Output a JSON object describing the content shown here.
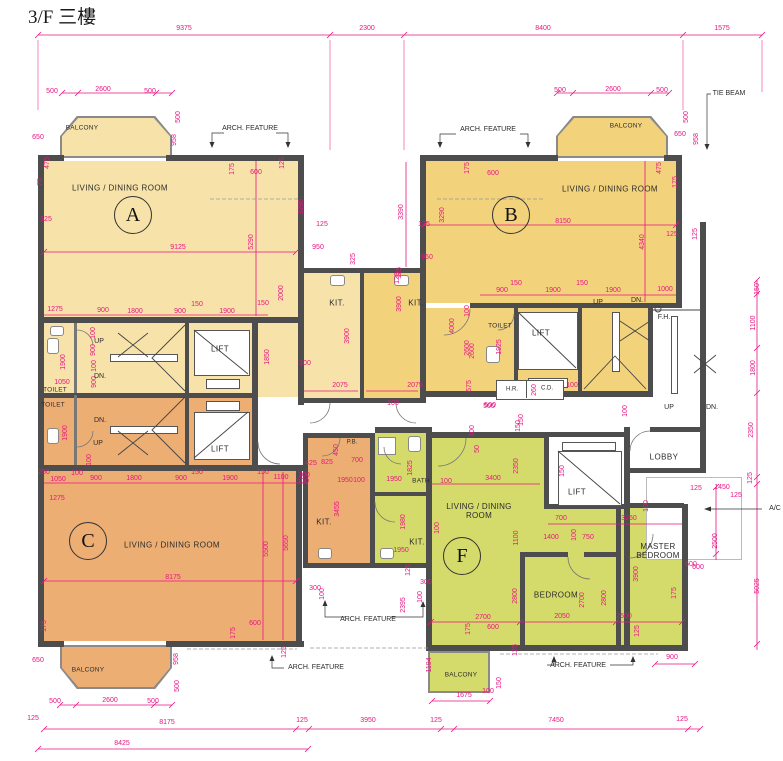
{
  "title": "3/F 三樓",
  "colors": {
    "unitA": "#F7E3A9",
    "unitB": "#F3D27C",
    "unitC": "#EDAE74",
    "unitF": "#D5DB6A",
    "wall": "#4D4D4D",
    "dim": "#E91583"
  },
  "units": [
    {
      "letter": "A",
      "main_room": "LIVING / DINING ROOM"
    },
    {
      "letter": "B",
      "main_room": "LIVING / DINING ROOM"
    },
    {
      "letter": "C",
      "main_room": "LIVING / DINING ROOM"
    },
    {
      "letter": "F",
      "main_room": "LIVING / DINING ROOM"
    }
  ],
  "labels": [
    {
      "t": "9375",
      "x": 184,
      "y": 29
    },
    {
      "t": "2300",
      "x": 367,
      "y": 29
    },
    {
      "t": "8400",
      "x": 543,
      "y": 29
    },
    {
      "t": "1575",
      "x": 722,
      "y": 29
    },
    {
      "n": "unit-a-balcony-label",
      "t": "BALCONY",
      "x": 82,
      "y": 128,
      "s": "rs"
    },
    {
      "t": "500",
      "x": 52,
      "y": 92
    },
    {
      "t": "2600",
      "x": 103,
      "y": 90
    },
    {
      "t": "500",
      "x": 150,
      "y": 92
    },
    {
      "t": "650",
      "x": 38,
      "y": 138
    },
    {
      "t": "500",
      "x": 179,
      "y": 117,
      "v": 1
    },
    {
      "t": "958",
      "x": 175,
      "y": 140,
      "v": 1
    },
    {
      "n": "arch-feature-top-left",
      "t": "ARCH. FEATURE",
      "x": 250,
      "y": 129,
      "s": "a"
    },
    {
      "n": "arch-feature-top-right",
      "t": "ARCH. FEATURE",
      "x": 488,
      "y": 130,
      "s": "a"
    },
    {
      "n": "tie-beam-label",
      "t": "TIE BEAM",
      "x": 729,
      "y": 94,
      "s": "a"
    },
    {
      "n": "unit-a-room-label",
      "t": "LIVING / DINING ROOM",
      "x": 120,
      "y": 188,
      "s": "r"
    },
    {
      "n": "unit-a-letter",
      "t": "A",
      "x": 133,
      "y": 215,
      "s": "c"
    },
    {
      "t": "475",
      "x": 48,
      "y": 163,
      "v": 1
    },
    {
      "t": "75",
      "x": 41,
      "y": 182,
      "v": 1
    },
    {
      "t": "125",
      "x": 46,
      "y": 220
    },
    {
      "t": "9125",
      "x": 178,
      "y": 248
    },
    {
      "t": "5290",
      "x": 252,
      "y": 242,
      "v": 1
    },
    {
      "t": "3290",
      "x": 302,
      "y": 207,
      "v": 1
    },
    {
      "t": "175",
      "x": 233,
      "y": 169,
      "v": 1
    },
    {
      "t": "600",
      "x": 256,
      "y": 173
    },
    {
      "t": "125",
      "x": 283,
      "y": 163,
      "v": 1
    },
    {
      "t": "3390",
      "x": 402,
      "y": 212,
      "v": 1
    },
    {
      "t": "125",
      "x": 322,
      "y": 225
    },
    {
      "t": "950",
      "x": 318,
      "y": 248
    },
    {
      "t": "325",
      "x": 354,
      "y": 259,
      "v": 1
    },
    {
      "t": "125",
      "x": 424,
      "y": 225
    },
    {
      "t": "950",
      "x": 427,
      "y": 258
    },
    {
      "t": "125",
      "x": 400,
      "y": 273,
      "v": 1
    },
    {
      "n": "unit-b-room-label",
      "t": "LIVING / DINING ROOM",
      "x": 610,
      "y": 189,
      "s": "r"
    },
    {
      "n": "unit-b-letter",
      "t": "B",
      "x": 511,
      "y": 215,
      "s": "c"
    },
    {
      "t": "175",
      "x": 468,
      "y": 168,
      "v": 1
    },
    {
      "t": "600",
      "x": 493,
      "y": 174
    },
    {
      "t": "3290",
      "x": 443,
      "y": 215,
      "v": 1
    },
    {
      "t": "8150",
      "x": 563,
      "y": 222
    },
    {
      "t": "125",
      "x": 672,
      "y": 235
    },
    {
      "t": "4340",
      "x": 643,
      "y": 242,
      "v": 1
    },
    {
      "t": "475",
      "x": 660,
      "y": 168,
      "v": 1
    },
    {
      "t": "175",
      "x": 676,
      "y": 182,
      "v": 1
    },
    {
      "n": "unit-b-balcony-label",
      "t": "BALCONY",
      "x": 626,
      "y": 126,
      "s": "rs"
    },
    {
      "t": "500",
      "x": 560,
      "y": 91
    },
    {
      "t": "2600",
      "x": 613,
      "y": 90
    },
    {
      "t": "500",
      "x": 662,
      "y": 91
    },
    {
      "t": "650",
      "x": 680,
      "y": 135
    },
    {
      "t": "500",
      "x": 687,
      "y": 117,
      "v": 1
    },
    {
      "t": "958",
      "x": 697,
      "y": 139,
      "v": 1
    },
    {
      "t": "900",
      "x": 502,
      "y": 291
    },
    {
      "t": "150",
      "x": 516,
      "y": 284
    },
    {
      "t": "1900",
      "x": 553,
      "y": 291
    },
    {
      "t": "150",
      "x": 582,
      "y": 284
    },
    {
      "t": "1900",
      "x": 613,
      "y": 291
    },
    {
      "t": "1000",
      "x": 665,
      "y": 290
    },
    {
      "n": "b-stair-up",
      "t": "UP",
      "x": 598,
      "y": 303,
      "s": "a"
    },
    {
      "n": "b-stair-dn",
      "t": "DN.",
      "x": 637,
      "y": 301,
      "s": "a"
    },
    {
      "n": "fire-hydrant-label",
      "t": "F.H.",
      "x": 664,
      "y": 318,
      "s": "a"
    },
    {
      "n": "unit-b-toilet-label",
      "t": "TOILET",
      "x": 500,
      "y": 326,
      "s": "rs"
    },
    {
      "n": "lift-b-label",
      "t": "LIFT",
      "x": 541,
      "y": 333,
      "s": "r"
    },
    {
      "t": "1925",
      "x": 500,
      "y": 347,
      "v": 1
    },
    {
      "t": "2600",
      "x": 473,
      "y": 351,
      "v": 1
    },
    {
      "n": "hose-reel-label",
      "t": "H.R.",
      "x": 512,
      "y": 390,
      "s": "a6"
    },
    {
      "n": "cable-duct-label",
      "t": "C.D.",
      "x": 547,
      "y": 389,
      "s": "a6"
    },
    {
      "t": "100",
      "x": 572,
      "y": 386
    },
    {
      "t": "260",
      "x": 535,
      "y": 390,
      "v": 1
    },
    {
      "t": "500",
      "x": 489,
      "y": 407
    },
    {
      "t": "150",
      "x": 522,
      "y": 420,
      "v": 1
    },
    {
      "t": "100",
      "x": 626,
      "y": 411,
      "v": 1
    },
    {
      "n": "ext-stair-up",
      "t": "UP",
      "x": 669,
      "y": 408,
      "s": "a"
    },
    {
      "n": "ext-stair-dn",
      "t": "DN.",
      "x": 712,
      "y": 408,
      "s": "a"
    },
    {
      "t": "125",
      "x": 696,
      "y": 234,
      "v": 1
    },
    {
      "t": "150",
      "x": 758,
      "y": 289,
      "v": 1
    },
    {
      "t": "1100",
      "x": 754,
      "y": 323,
      "v": 1
    },
    {
      "t": "1800",
      "x": 754,
      "y": 368,
      "v": 1
    },
    {
      "t": "2350",
      "x": 752,
      "y": 430,
      "v": 1
    },
    {
      "t": "125",
      "x": 751,
      "y": 478,
      "v": 1
    },
    {
      "t": "5025",
      "x": 758,
      "y": 586,
      "v": 1
    },
    {
      "t": "2500",
      "x": 716,
      "y": 541,
      "v": 1
    },
    {
      "t": "125",
      "x": 696,
      "y": 489
    },
    {
      "t": "1450",
      "x": 722,
      "y": 488
    },
    {
      "t": "125",
      "x": 736,
      "y": 496
    },
    {
      "n": "ac-label",
      "t": "A/C",
      "x": 775,
      "y": 509,
      "s": "a"
    },
    {
      "t": "100",
      "x": 647,
      "y": 506,
      "v": 1
    },
    {
      "t": "600",
      "x": 698,
      "y": 568
    },
    {
      "n": "lobby-label",
      "t": "LOBBY",
      "x": 664,
      "y": 457,
      "s": "r"
    },
    {
      "n": "master-bedroom-label",
      "t": "MASTER\nBEDROOM",
      "x": 658,
      "y": 551,
      "s": "r2"
    },
    {
      "t": "1275",
      "x": 55,
      "y": 310
    },
    {
      "t": "900",
      "x": 103,
      "y": 311
    },
    {
      "t": "1800",
      "x": 135,
      "y": 312
    },
    {
      "t": "900",
      "x": 180,
      "y": 312
    },
    {
      "t": "150",
      "x": 197,
      "y": 305
    },
    {
      "t": "1900",
      "x": 227,
      "y": 312
    },
    {
      "t": "150",
      "x": 263,
      "y": 304
    },
    {
      "t": "100",
      "x": 94,
      "y": 333,
      "v": 1
    },
    {
      "t": "900",
      "x": 94,
      "y": 350,
      "v": 1
    },
    {
      "t": "100",
      "x": 95,
      "y": 366,
      "v": 1
    },
    {
      "t": "900",
      "x": 95,
      "y": 382,
      "v": 1
    },
    {
      "t": "1050",
      "x": 62,
      "y": 383
    },
    {
      "t": "1900",
      "x": 64,
      "y": 362,
      "v": 1
    },
    {
      "t": "1900",
      "x": 66,
      "y": 433,
      "v": 1
    },
    {
      "t": "100",
      "x": 90,
      "y": 460,
      "v": 1
    },
    {
      "n": "unit-a-toilet-label",
      "t": "TOILET",
      "x": 55,
      "y": 390,
      "s": "rs"
    },
    {
      "n": "unit-c-toilet-label",
      "t": "TOILET",
      "x": 53,
      "y": 405,
      "s": "rs"
    },
    {
      "n": "a-stair-up",
      "t": "UP",
      "x": 99,
      "y": 342,
      "s": "a"
    },
    {
      "n": "a-stair-dn",
      "t": "DN.",
      "x": 100,
      "y": 377,
      "s": "a"
    },
    {
      "n": "c-stair-dn",
      "t": "DN.",
      "x": 100,
      "y": 421,
      "s": "a"
    },
    {
      "n": "c-stair-up",
      "t": "UP",
      "x": 98,
      "y": 444,
      "s": "a"
    },
    {
      "n": "lift-a-label",
      "t": "LIFT",
      "x": 220,
      "y": 349,
      "s": "r"
    },
    {
      "n": "lift-c-label",
      "t": "LIFT",
      "x": 220,
      "y": 449,
      "s": "r"
    },
    {
      "t": "1850",
      "x": 268,
      "y": 357,
      "v": 1
    },
    {
      "n": "unit-a-kitchen-label",
      "t": "KIT.",
      "x": 337,
      "y": 303,
      "s": "r"
    },
    {
      "n": "unit-b-kitchen-label",
      "t": "KIT.",
      "x": 416,
      "y": 303,
      "s": "r"
    },
    {
      "t": "2000",
      "x": 282,
      "y": 293,
      "v": 1
    },
    {
      "t": "3900",
      "x": 348,
      "y": 336,
      "v": 1
    },
    {
      "t": "3900",
      "x": 400,
      "y": 304,
      "v": 1
    },
    {
      "t": "4000",
      "x": 453,
      "y": 326,
      "v": 1
    },
    {
      "t": "125",
      "x": 398,
      "y": 278,
      "v": 1
    },
    {
      "t": "2075",
      "x": 340,
      "y": 386
    },
    {
      "t": "2075",
      "x": 415,
      "y": 386
    },
    {
      "t": "100",
      "x": 305,
      "y": 364
    },
    {
      "t": "100",
      "x": 393,
      "y": 404
    },
    {
      "t": "100",
      "x": 468,
      "y": 311,
      "v": 1
    },
    {
      "t": "2600",
      "x": 468,
      "y": 348,
      "v": 1
    },
    {
      "t": "575",
      "x": 470,
      "y": 386,
      "v": 1
    },
    {
      "t": "500",
      "x": 490,
      "y": 406
    },
    {
      "t": "250",
      "x": 44,
      "y": 473
    },
    {
      "t": "1050",
      "x": 58,
      "y": 480
    },
    {
      "t": "100",
      "x": 77,
      "y": 474
    },
    {
      "t": "900",
      "x": 96,
      "y": 479
    },
    {
      "t": "1800",
      "x": 134,
      "y": 479
    },
    {
      "t": "900",
      "x": 181,
      "y": 479
    },
    {
      "t": "150",
      "x": 197,
      "y": 473
    },
    {
      "t": "1900",
      "x": 230,
      "y": 479
    },
    {
      "t": "150",
      "x": 263,
      "y": 473
    },
    {
      "t": "1100",
      "x": 281,
      "y": 478
    },
    {
      "t": "100",
      "x": 304,
      "y": 476
    },
    {
      "t": "1275",
      "x": 57,
      "y": 499
    },
    {
      "n": "unit-c-letter",
      "t": "C",
      "x": 88,
      "y": 541,
      "s": "c"
    },
    {
      "n": "unit-c-room-label",
      "t": "LIVING / DINING ROOM",
      "x": 172,
      "y": 545,
      "s": "r"
    },
    {
      "t": "8175",
      "x": 173,
      "y": 578
    },
    {
      "t": "5500",
      "x": 267,
      "y": 549,
      "v": 1
    },
    {
      "t": "5650",
      "x": 287,
      "y": 543,
      "v": 1
    },
    {
      "t": "175",
      "x": 45,
      "y": 626,
      "v": 1
    },
    {
      "t": "600",
      "x": 255,
      "y": 624
    },
    {
      "t": "175",
      "x": 234,
      "y": 633,
      "v": 1
    },
    {
      "t": "125",
      "x": 285,
      "y": 652,
      "v": 1
    },
    {
      "t": "650",
      "x": 38,
      "y": 661
    },
    {
      "n": "unit-c-balcony-label",
      "t": "BALCONY",
      "x": 88,
      "y": 670,
      "s": "rs"
    },
    {
      "t": "958",
      "x": 177,
      "y": 659,
      "v": 1
    },
    {
      "t": "500",
      "x": 178,
      "y": 686,
      "v": 1
    },
    {
      "t": "500",
      "x": 55,
      "y": 702
    },
    {
      "t": "2600",
      "x": 110,
      "y": 701
    },
    {
      "t": "500",
      "x": 153,
      "y": 702
    },
    {
      "t": "125",
      "x": 33,
      "y": 719
    },
    {
      "t": "8175",
      "x": 167,
      "y": 723
    },
    {
      "t": "8425",
      "x": 122,
      "y": 744
    },
    {
      "n": "arch-feature-bottom-left",
      "t": "ARCH. FEATURE",
      "x": 316,
      "y": 668,
      "s": "a"
    },
    {
      "n": "pipe-duct-label",
      "t": "P.B.",
      "x": 352,
      "y": 443,
      "s": "a6"
    },
    {
      "t": "450",
      "x": 337,
      "y": 450,
      "v": 1
    },
    {
      "t": "425",
      "x": 311,
      "y": 464
    },
    {
      "t": "825",
      "x": 327,
      "y": 463
    },
    {
      "t": "700",
      "x": 357,
      "y": 461
    },
    {
      "t": "100",
      "x": 303,
      "y": 482
    },
    {
      "t": "1950",
      "x": 345,
      "y": 481
    },
    {
      "t": "100",
      "x": 359,
      "y": 481
    },
    {
      "t": "1950",
      "x": 394,
      "y": 480
    },
    {
      "n": "bath-label",
      "t": "BATH",
      "x": 421,
      "y": 481,
      "s": "rs"
    },
    {
      "t": "100",
      "x": 446,
      "y": 482
    },
    {
      "t": "1825",
      "x": 411,
      "y": 468,
      "v": 1
    },
    {
      "t": "3455",
      "x": 338,
      "y": 509,
      "v": 1
    },
    {
      "n": "unit-c-kitchen-label",
      "t": "KIT.",
      "x": 324,
      "y": 522,
      "s": "r"
    },
    {
      "t": "1980",
      "x": 404,
      "y": 522,
      "v": 1
    },
    {
      "n": "unit-f-kitchen-label",
      "t": "KIT.",
      "x": 417,
      "y": 542,
      "s": "r"
    },
    {
      "t": "1950",
      "x": 401,
      "y": 551
    },
    {
      "t": "125",
      "x": 409,
      "y": 570,
      "v": 1
    },
    {
      "t": "300",
      "x": 315,
      "y": 589
    },
    {
      "t": "100",
      "x": 323,
      "y": 594,
      "v": 1
    },
    {
      "t": "300",
      "x": 426,
      "y": 583
    },
    {
      "t": "100",
      "x": 421,
      "y": 597,
      "v": 1
    },
    {
      "t": "2395",
      "x": 404,
      "y": 605,
      "v": 1
    },
    {
      "n": "arch-feature-bottom-mid",
      "t": "ARCH. FEATURE",
      "x": 368,
      "y": 620,
      "s": "a"
    },
    {
      "t": "100",
      "x": 473,
      "y": 431,
      "v": 1
    },
    {
      "t": "150",
      "x": 519,
      "y": 426,
      "v": 1
    },
    {
      "t": "50",
      "x": 478,
      "y": 449,
      "v": 1
    },
    {
      "t": "3400",
      "x": 493,
      "y": 479
    },
    {
      "t": "2350",
      "x": 517,
      "y": 466,
      "v": 1
    },
    {
      "t": "150",
      "x": 563,
      "y": 471,
      "v": 1
    },
    {
      "n": "lift-f-label",
      "t": "LIFT",
      "x": 577,
      "y": 492,
      "s": "r"
    },
    {
      "n": "unit-f-room-label",
      "t": "LIVING / DINING\nROOM",
      "x": 479,
      "y": 511,
      "s": "r2"
    },
    {
      "n": "unit-f-letter",
      "t": "F",
      "x": 462,
      "y": 556,
      "s": "c"
    },
    {
      "t": "100",
      "x": 438,
      "y": 528,
      "v": 1
    },
    {
      "t": "1100",
      "x": 517,
      "y": 538,
      "v": 1
    },
    {
      "t": "700",
      "x": 561,
      "y": 519
    },
    {
      "t": "3250",
      "x": 629,
      "y": 519
    },
    {
      "t": "1400",
      "x": 551,
      "y": 538
    },
    {
      "t": "100",
      "x": 575,
      "y": 535,
      "v": 1
    },
    {
      "t": "750",
      "x": 588,
      "y": 538
    },
    {
      "t": "3900",
      "x": 637,
      "y": 574,
      "v": 1
    },
    {
      "t": "2800",
      "x": 516,
      "y": 596,
      "v": 1
    },
    {
      "n": "bedroom-label",
      "t": "BEDROOM",
      "x": 556,
      "y": 595,
      "s": "r"
    },
    {
      "t": "2700",
      "x": 583,
      "y": 600,
      "v": 1
    },
    {
      "t": "2800",
      "x": 605,
      "y": 598,
      "v": 1
    },
    {
      "t": "2700",
      "x": 483,
      "y": 618
    },
    {
      "t": "600",
      "x": 493,
      "y": 628
    },
    {
      "t": "2050",
      "x": 562,
      "y": 617
    },
    {
      "t": "2500",
      "x": 624,
      "y": 617
    },
    {
      "t": "175",
      "x": 469,
      "y": 629,
      "v": 1
    },
    {
      "t": "125",
      "x": 516,
      "y": 650,
      "v": 1
    },
    {
      "t": "125",
      "x": 638,
      "y": 631,
      "v": 1
    },
    {
      "t": "900",
      "x": 672,
      "y": 658
    },
    {
      "t": "600",
      "x": 691,
      "y": 565
    },
    {
      "t": "175",
      "x": 675,
      "y": 593,
      "v": 1
    },
    {
      "n": "unit-f-balcony-label",
      "t": "BALCONY",
      "x": 461,
      "y": 675,
      "s": "rs"
    },
    {
      "t": "1675",
      "x": 464,
      "y": 696
    },
    {
      "t": "100",
      "x": 488,
      "y": 692
    },
    {
      "t": "150",
      "x": 500,
      "y": 683,
      "v": 1
    },
    {
      "t": "1194",
      "x": 430,
      "y": 665,
      "v": 1
    },
    {
      "n": "arch-feature-bottom-right",
      "t": "ARCH. FEATURE",
      "x": 578,
      "y": 666,
      "s": "a"
    },
    {
      "t": "125",
      "x": 302,
      "y": 721
    },
    {
      "t": "3950",
      "x": 368,
      "y": 721
    },
    {
      "t": "125",
      "x": 436,
      "y": 721
    },
    {
      "t": "7450",
      "x": 556,
      "y": 721
    },
    {
      "t": "125",
      "x": 682,
      "y": 720
    }
  ]
}
